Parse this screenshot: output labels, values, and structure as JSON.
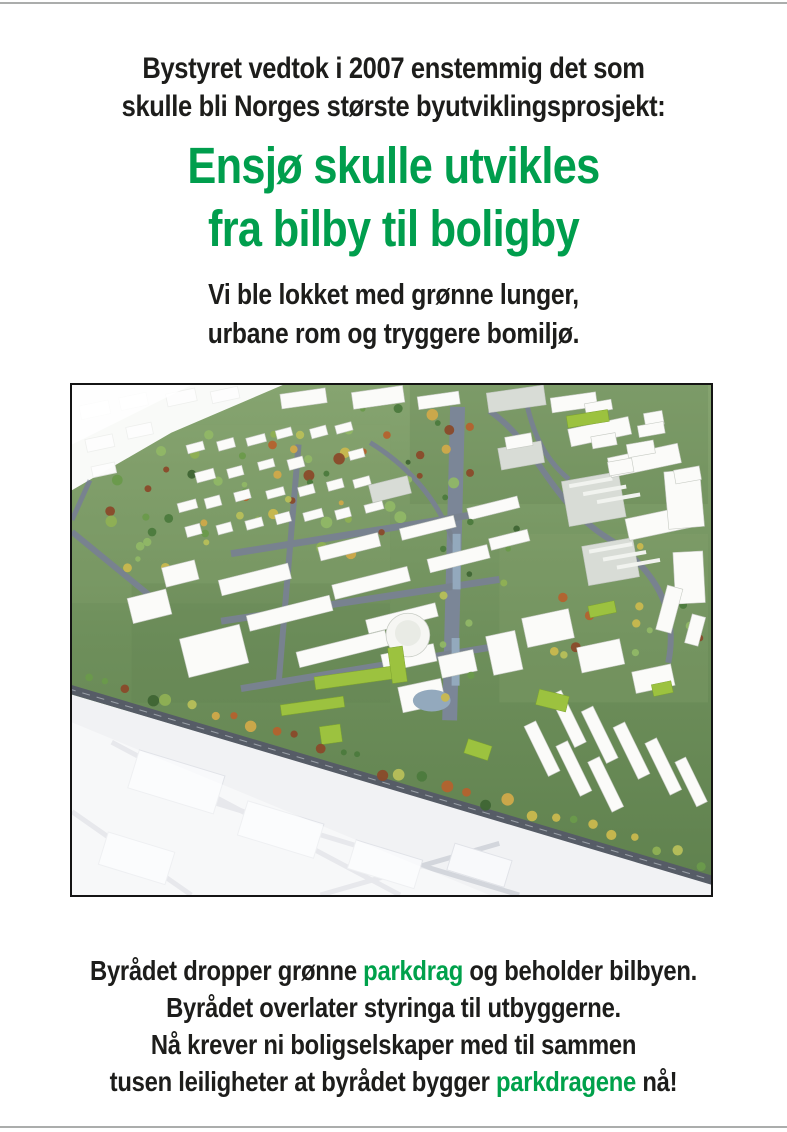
{
  "intro": {
    "line1": "Bystyret vedtok i 2007 enstemmig det som",
    "line2": "skulle bli Norges største byutviklingsprosjekt:"
  },
  "headline": {
    "line1": "Ensjø skulle utvikles",
    "line2": "fra bilby til boligby",
    "color": "#009e4d"
  },
  "subtitle": {
    "line1": "Vi ble lokket med grønne lunger,",
    "line2": "urbane rom og tryggere bomiljø."
  },
  "footer": {
    "line1": {
      "pre": "Byrådet dropper grønne ",
      "green": "parkdrag",
      "post": " og beholder bilbyen."
    },
    "line2": "Byrådet overlater styringa til utbyggerne.",
    "line3": "Nå krever ni boligselskaper med til sammen",
    "line4": {
      "pre": "tusen leiligheter at byrådet bygger ",
      "green": "parkdragene",
      "post": " nå!"
    }
  },
  "dividers": {
    "color": "#abadac"
  },
  "aerial_image": {
    "name": "ensjo-plan-aerial-rendering",
    "border_color": "#141414",
    "palette": {
      "grass": "#6e8f5b",
      "grass_light": "#86a470",
      "grass_dark": "#5f814e",
      "road": "#78828f",
      "boulevard": "#7b8697",
      "road_dark": "#565c66",
      "building_white": "#fbfbf9",
      "building_stroke": "#c6cac3",
      "building_gray": "#d8dcd6",
      "massing_white": "#f1f2f4",
      "lime_roof": "#9cc23f",
      "water": "#93a9bd",
      "trees": [
        "#4c7a3d",
        "#6a9a4b",
        "#8fb054",
        "#b7bf5a",
        "#d0a94a",
        "#b4622e",
        "#8a4a2a",
        "#3f6534",
        "#90b766",
        "#c9b84e"
      ]
    }
  }
}
